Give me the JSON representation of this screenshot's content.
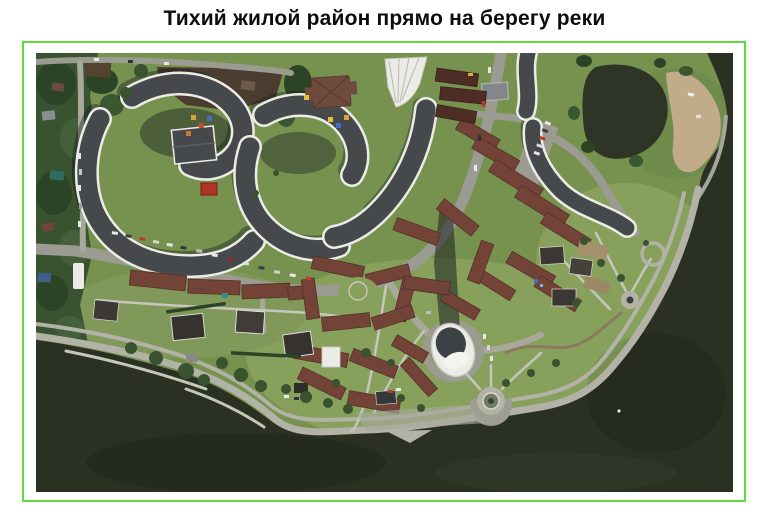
{
  "page": {
    "title": "Тихий жилой район прямо на берегу реки"
  },
  "figure": {
    "description": "Satellite aerial photo of a quiet residential district on a river bank: curved white apartment complexes, red-roofed townhouse clusters, a round white tower, green park, curved embankment promenade and dark river water",
    "border_color_name": "bright green"
  },
  "palette": {
    "border_green": "#5fdb40",
    "water": "#2a3123",
    "pond": "#2e3526",
    "grass": "#77924f",
    "grass_light": "#87a15d",
    "road": "#9b9b91",
    "road_light": "#a8a89c",
    "path": "#c6c6ba",
    "promenade": "#b2b2a6",
    "roof_dark": "#45494c",
    "building_white": "#ecece6",
    "roof_red": "#744338",
    "roof_red_dark": "#53302a",
    "sand": "#c2ab89",
    "tree": "#39522f",
    "tree_dark": "#2c4426",
    "soil": "#4a3d2f"
  }
}
